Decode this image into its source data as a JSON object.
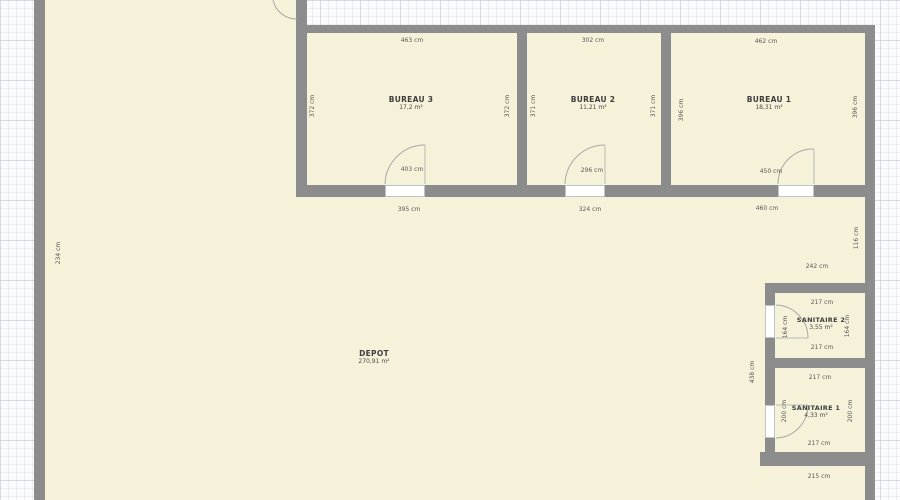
{
  "colors": {
    "floor": "#f6f2d9",
    "wall": "#8c8c8c",
    "paper": "#fbfbfd",
    "text": "#3d3d3d"
  },
  "rooms": {
    "bureau3": {
      "name": "BUREAU 3",
      "area": "17,2 m²"
    },
    "bureau2": {
      "name": "BUREAU 2",
      "area": "11,21 m²"
    },
    "bureau1": {
      "name": "BUREAU 1",
      "area": "18,31 m²"
    },
    "depot": {
      "name": "DEPOT",
      "area": "270,91 m²"
    },
    "sanitaire2": {
      "name": "SANITAIRE 2",
      "area": "3,55 m²"
    },
    "sanitaire1": {
      "name": "SANITAIRE 1",
      "area": "4,33 m²"
    }
  },
  "dims": {
    "b3_top": "463 cm",
    "b3_left": "372 cm",
    "b3_right": "372 cm",
    "b3_door": "403 cm",
    "b3_below": "395 cm",
    "b2_top": "302 cm",
    "b2_left": "371 cm",
    "b2_right": "371 cm",
    "b2_door": "296 cm",
    "b2_below": "324 cm",
    "b1_top": "462 cm",
    "b1_left": "396 cm",
    "b1_right": "396 cm",
    "b1_door": "450 cm",
    "b1_below": "460 cm",
    "right_mid": "116 cm",
    "passage": "242 cm",
    "left_side": "234 cm",
    "depot_right": "438 cm",
    "s2_top": "217 cm",
    "s2_left": "164 cm",
    "s2_right": "164 cm",
    "s2_bottom": "217 cm",
    "s1_top": "217 cm",
    "s1_left": "200 cm",
    "s1_right": "200 cm",
    "s1_bottom": "217 cm",
    "below_s1": "215 cm"
  }
}
